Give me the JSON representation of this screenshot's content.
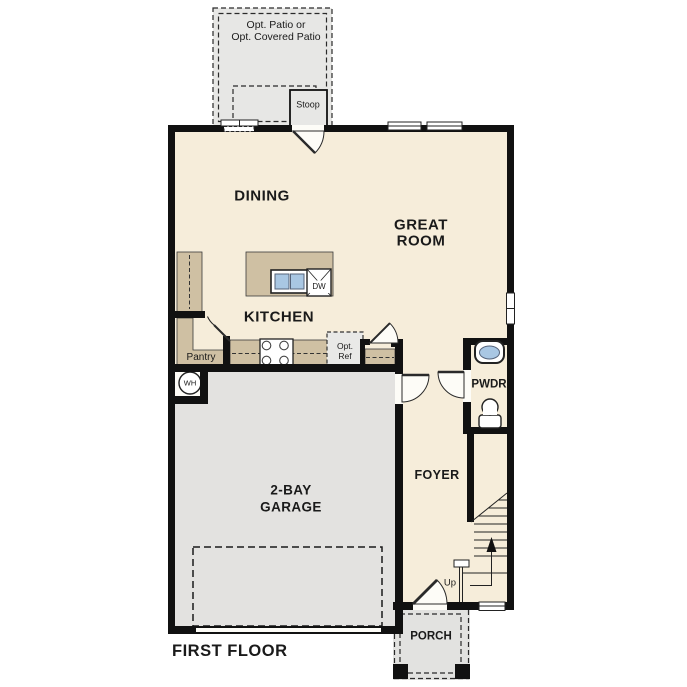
{
  "colors": {
    "wall": "#111111",
    "floor": "#f6edda",
    "garage": "#e3e2e0",
    "patio": "#e7e7e5",
    "porch": "#e2e2e0",
    "counter": "#cfc0a3",
    "optional": "#e9e9e7",
    "sink_blue": "#a9c7e3",
    "text": "#1a1a1a"
  },
  "plan": {
    "title": "FIRST FLOOR",
    "rooms": {
      "dining": "DINING",
      "great_room": [
        "GREAT",
        "ROOM"
      ],
      "kitchen": "KITCHEN",
      "garage": [
        "2-BAY",
        "GARAGE"
      ],
      "foyer": "FOYER",
      "powder": "PWDR",
      "porch": "PORCH",
      "pantry": "Pantry",
      "stoop": "Stoop"
    },
    "options": {
      "patio": [
        "Opt. Patio or",
        "Opt. Covered Patio"
      ],
      "refrigerator": [
        "Opt.",
        "Ref"
      ]
    },
    "fixtures": {
      "water_heater": "WH",
      "dishwasher": "DW",
      "stairs_direction": "Up"
    }
  }
}
